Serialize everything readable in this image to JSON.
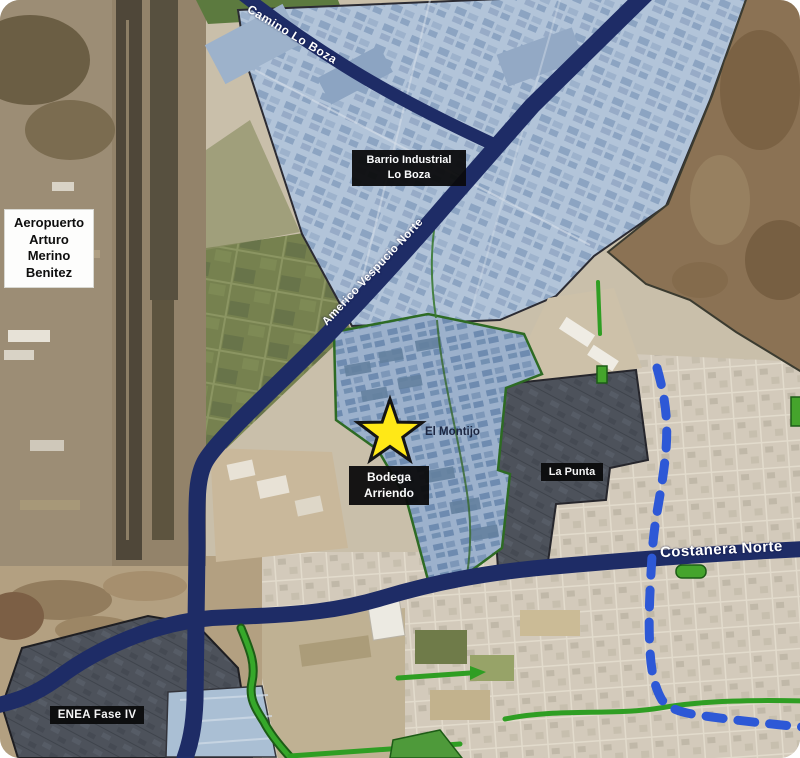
{
  "map": {
    "labels": {
      "camino_lo_boza": "Camino Lo Boza",
      "barrio_industrial": "Barrio Industrial\nLo Boza",
      "aeropuerto": "Aeropuerto\nArturo\nMerino\nBenitez",
      "vespucio_norte": "Americo Vespucio Norte",
      "el_montijo": "El Montijo",
      "bodega_arriendo": "Bodega\nArriendo",
      "la_punta": "La Punta",
      "costanera_norte": "Costanera Norte",
      "enea_fase_iv": "ENEA Fase IV"
    },
    "marker": {
      "type": "star",
      "color": "#ffe817",
      "outline": "#141414"
    },
    "colors": {
      "highway_navy": "#1e2c66",
      "dashed_route_blue": "#2d58d6",
      "green_line": "#2f9e23",
      "zone_light_blue": "#b2c4d9",
      "zone_periwinkle": "#9cb1cc",
      "zone_dark_gray": "#4d525b",
      "mountain_brown": "#8b7254",
      "city_tan": "#d3cabb",
      "field_green": "#76814f"
    }
  }
}
